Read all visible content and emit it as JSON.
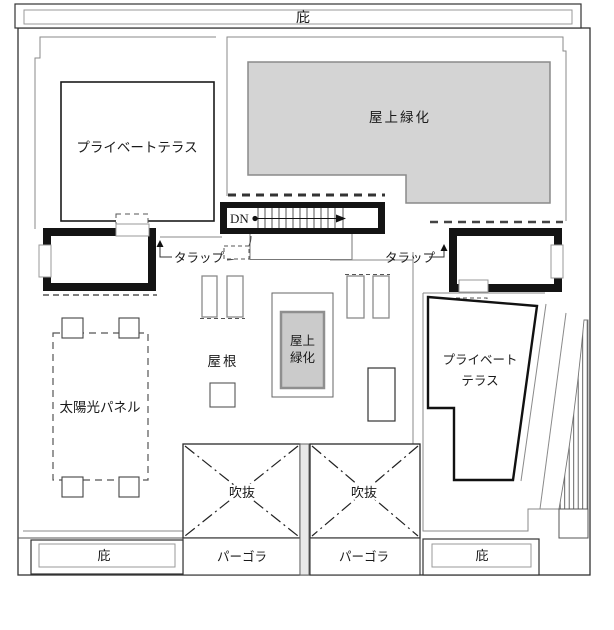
{
  "plan": {
    "canopy_top": {
      "label": "庇"
    },
    "upper_left_terrace": {
      "label": "プライベートテラス"
    },
    "green_roof_large": {
      "label": "屋上緑化"
    },
    "stair": {
      "label": "DN"
    },
    "ladders": {
      "left": "タラップ",
      "right": "タラップ"
    },
    "roof_label": "屋根",
    "green_roof_small": {
      "line1": "屋上",
      "line2": "緑化"
    },
    "solar_panel": {
      "label": "太陽光パネル"
    },
    "lower_right_terrace": {
      "line1": "プライベート",
      "line2": "テラス"
    },
    "voids": {
      "left": "吹抜",
      "right": "吹抜"
    },
    "pergolas": {
      "left": "パーゴラ",
      "right": "パーゴラ"
    },
    "canopy_bottom": {
      "left": "庇",
      "right": "庇"
    }
  },
  "colors": {
    "line_dark": "#1a1a1a",
    "line_gray": "#8a8a8a",
    "green_fill_large": "#d4d4d4",
    "green_fill_small": "#cbcbcb",
    "background": "#ffffff"
  }
}
